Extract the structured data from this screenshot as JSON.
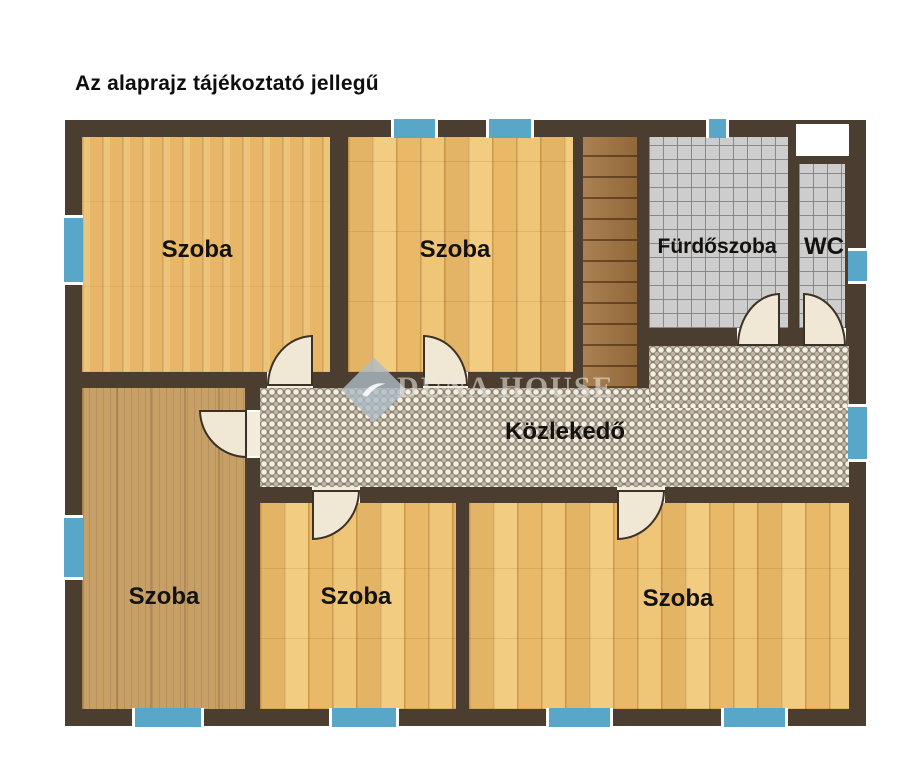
{
  "title": "Az alaprajz tájékoztató jellegű",
  "watermark": {
    "brand": "DUNA HOUSE"
  },
  "rooms": {
    "top_left": {
      "label": "Szoba",
      "floor": "wood-planks"
    },
    "top_middle": {
      "label": "Szoba",
      "floor": "wood-parquet"
    },
    "bathroom": {
      "label": "Fürdőszoba",
      "floor": "gray-tile"
    },
    "wc": {
      "label": "WC",
      "floor": "gray-tile"
    },
    "hallway": {
      "label": "Közlekedő",
      "floor": "mosaic-tile"
    },
    "bottom_left": {
      "label": "Szoba",
      "floor": "wood-tan"
    },
    "bottom_middle": {
      "label": "Szoba",
      "floor": "wood-parquet"
    },
    "bottom_right": {
      "label": "Szoba",
      "floor": "wood-parquet"
    }
  },
  "colors": {
    "wall": "#4b3e31",
    "window_blue": "#58a6c8",
    "tile_gray": "#cdcdcd",
    "mosaic_base": "#8b8171",
    "wood_light": "#e7b767",
    "wood_parquet": "#efc677",
    "wood_tan": "#c7a067",
    "stairs_wood": "#a1733f",
    "door_leaf": "#f0e7d4"
  }
}
